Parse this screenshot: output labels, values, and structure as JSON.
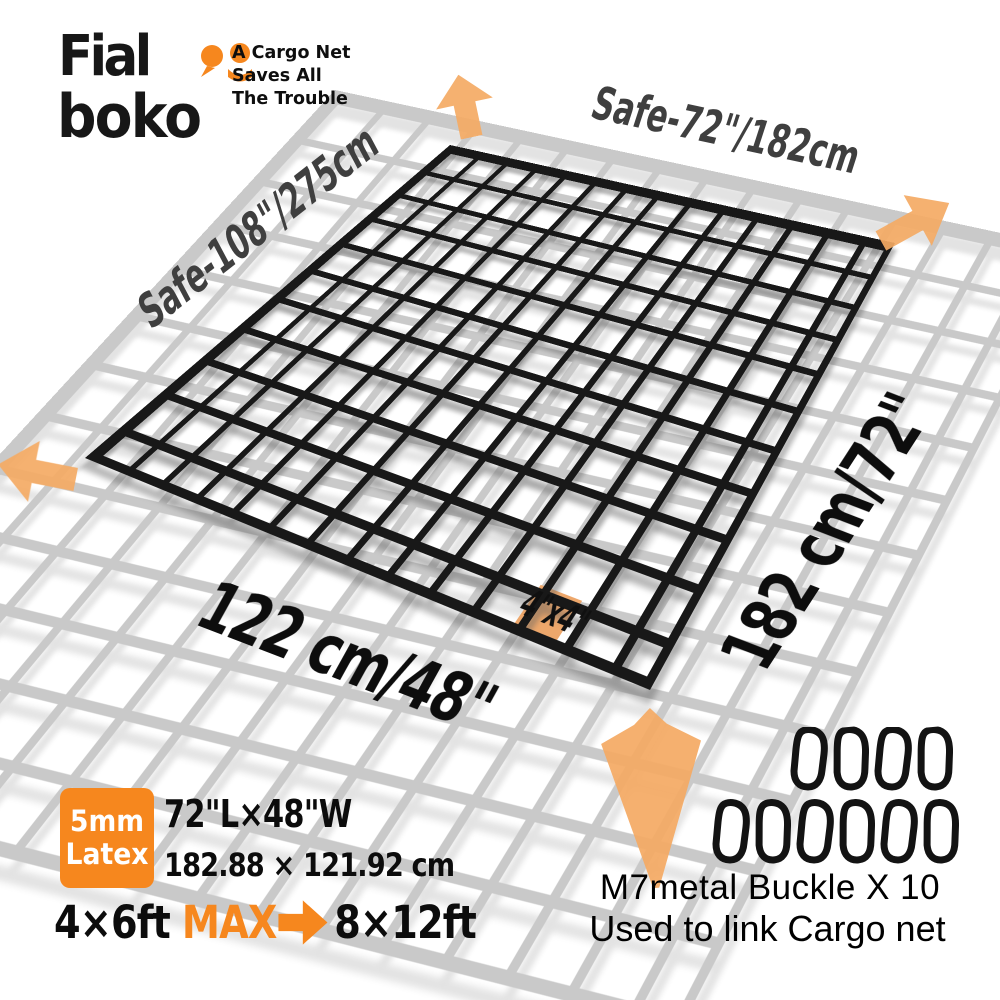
{
  "colors": {
    "accent_orange": "#f6871e",
    "arrow_orange": "#f4aa64",
    "highlight_cell_orange": "#eda76b",
    "white_net_gray": "#c9c9c9",
    "black_net": "#181818",
    "safe_label_gray": "#3f3f3f"
  },
  "header": {
    "brand_line1": "Fial",
    "brand_line2": "boko",
    "tagline": [
      "A Cargo Net",
      "Saves All",
      "The Trouble"
    ]
  },
  "net_diagram": {
    "safe_area_width_label": "Safe-72\"/182cm",
    "safe_area_length_label": "Safe-108\"/275cm",
    "net_length_label": "182 cm/72\"",
    "net_width_label": "122 cm/48\"",
    "mesh_size_label": "4\"x4\""
  },
  "specs": {
    "badge_line1": "5mm",
    "badge_line2": "Latex",
    "dimensions_inches": "72\"L×48\"W",
    "dimensions_cm": "182.88 × 121.92 cm",
    "stretch_from": "4×6ft",
    "stretch_max": "MAX",
    "stretch_to": "8×12ft"
  },
  "buckles": {
    "row1_count": 4,
    "row2_count": 6,
    "caption_line1": "M7metal Buckle X 10",
    "caption_line2": "Used to link Cargo net"
  }
}
